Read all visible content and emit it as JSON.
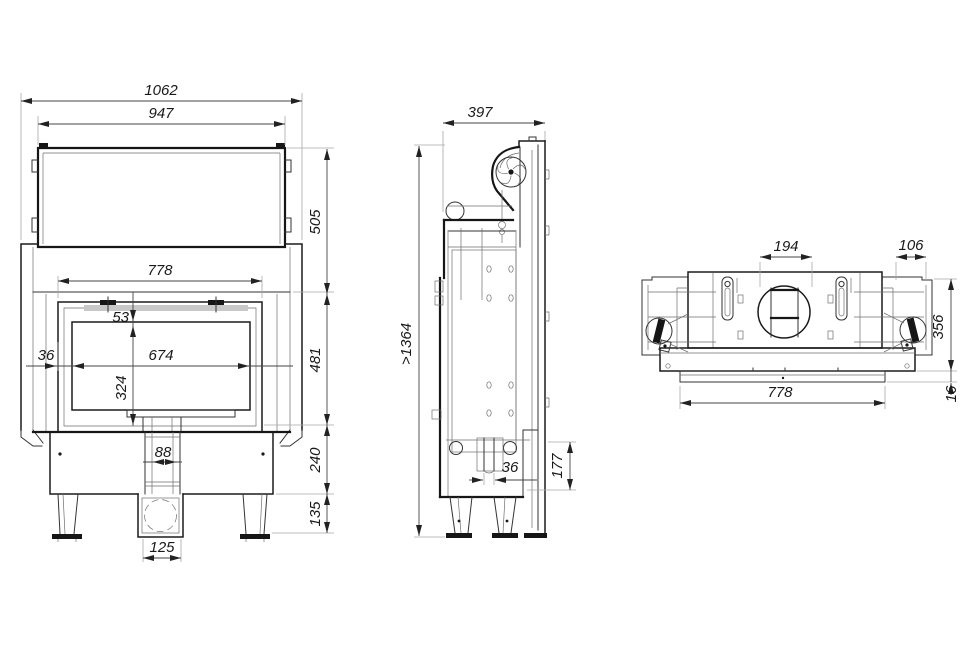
{
  "drawing_type": "fireplace-insert-technical-drawing",
  "colors": {
    "background": "#ffffff",
    "outline": "#161616",
    "dimension_text": "#191919",
    "extension_line": "#a9a9a9"
  },
  "views": {
    "front": {
      "dims": {
        "overall_width": "1062",
        "hood_width": "947",
        "hood_height": "505",
        "door_width": "778",
        "glass_top_offset": "53",
        "glass_side_offset": "36",
        "glass_width": "674",
        "glass_height": "324",
        "door_height": "481",
        "duct_width": "88",
        "plinth_height": "240",
        "leg_height": "135",
        "air_inlet_width": "125"
      }
    },
    "side": {
      "dims": {
        "depth": "397",
        "min_total_height": ">1364",
        "slot_depth": "36",
        "rear_clearance": "177"
      }
    },
    "top": {
      "dims": {
        "flue_width": "194",
        "side_panel_width": "106",
        "body_depth": "356",
        "front_width": "778",
        "lip_depth": "16"
      }
    }
  }
}
